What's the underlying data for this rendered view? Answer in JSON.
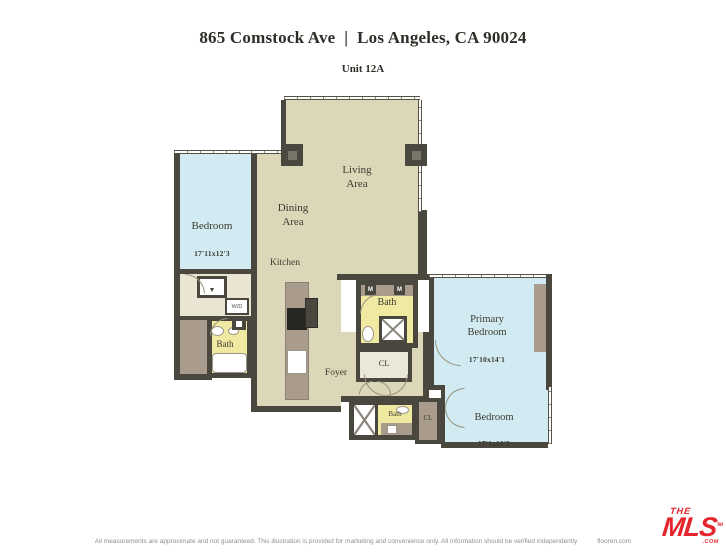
{
  "header": {
    "address": "865 Comstock Ave  |  Los Angeles, CA 90024",
    "unit": "Unit 12A"
  },
  "rooms": {
    "living": "Living\nArea",
    "dining": "Dining\nArea",
    "kitchen": "Kitchen",
    "foyer": "Foyer",
    "bedroom_left": {
      "name": "Bedroom",
      "dims": "17'11x12'3"
    },
    "primary_bedroom": {
      "name": "Primary\nBedroom",
      "dims": "17'10x14'1"
    },
    "bedroom_right": {
      "name": "Bedroom",
      "dims": "17'1x10'9"
    },
    "bath_left": "Bath",
    "bath_primary": "Bath",
    "bath_hall": "Bath",
    "closet_hall": "CL",
    "closet_bedroom": "CL",
    "washer_dryer": "W/D"
  },
  "icons": {
    "wardrobe": "M"
  },
  "footer": {
    "disclaimer": "All measurements are approximate and not guaranteed. This illustration is provided for marketing and convenience only. All information should be verified independently",
    "provider": "flooren.com"
  },
  "logo": {
    "the": "THE",
    "mls": "MLS",
    "com": ".COM",
    "tm": "TM"
  },
  "colors": {
    "wall": "#4a473f",
    "living": "#dbd7b8",
    "bedroom": "#d2ebf3",
    "bath": "#efe9a2",
    "closet": "#aa9c8c",
    "logo_red": "#e4262c"
  }
}
